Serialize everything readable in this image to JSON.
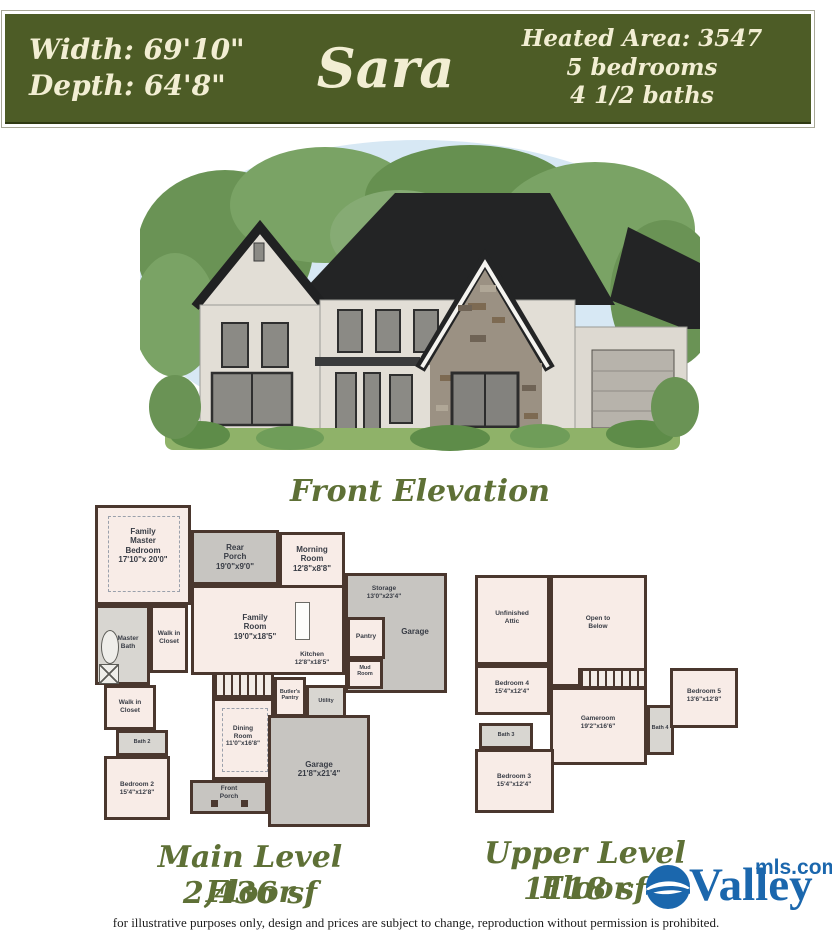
{
  "banner": {
    "width_label": "Width: 69'10\"",
    "depth_label": "Depth: 64'8\"",
    "plan_name": "Sara",
    "heated_area": "Heated Area: 3547",
    "bedrooms": "5 bedrooms",
    "baths": "4 1/2 baths"
  },
  "elevation": {
    "caption": "Front Elevation"
  },
  "main_level": {
    "caption": "Main Level Floor",
    "area": "2,436 sf",
    "rooms": {
      "family_master_bedroom": "Family\nMaster\nBedroom\n17'10\"x 20'0\"",
      "rear_porch": "Rear\nPorch\n19'0\"x9'0\"",
      "morning_room": "Morning\nRoom\n12'8\"x8'8\"",
      "family_room": "Family\nRoom\n19'0\"x18'5\"",
      "kitchen": "Kitchen\n12'8\"x18'5\"",
      "storage": "Storage\n13'0\"x23'4\"",
      "garage_side": "Garage",
      "pantry": "Pantry",
      "mud_room": "Mud\nRoom",
      "master_bath": "Master\nBath",
      "walk_in_closet_a": "Walk in\nCloset",
      "walk_in_closet_b": "Walk in\nCloset",
      "butlers_pantry": "Butler's\nPantry",
      "utility": "Utility",
      "dining_room": "Dining\nRoom\n11'0\"x16'8\"",
      "bath_2": "Bath 2",
      "bedroom_2": "Bedroom 2\n15'4\"x12'8\"",
      "front_porch": "Front\nPorch",
      "garage_main": "Garage\n21'8\"x21'4\""
    }
  },
  "upper_level": {
    "caption": "Upper Level Floor",
    "area": "1118 sf",
    "rooms": {
      "unfinished_attic": "Unfinished\nAttic",
      "open_to_below": "Open to\nBelow",
      "bedroom_4": "Bedroom 4\n15'4\"x12'4\"",
      "bedroom_5": "Bedroom 5\n13'6\"x12'8\"",
      "gameroom": "Gameroom\n19'2\"x16'6\"",
      "bath_3": "Bath 3",
      "bath_4": "Bath 4",
      "bedroom_3": "Bedroom 3\n15'4\"x12'4\""
    }
  },
  "footer": {
    "disclaimer": "for illustrative purposes only, design and prices are subject to change, reproduction without permission is prohibited.",
    "logo_valley": "Valley",
    "logo_mls": "mls.com"
  },
  "colors": {
    "banner_green": "#4d5c26",
    "banner_text_cream": "#f2eed3",
    "caption_olive": "#5e7036",
    "plan_wall_brown": "#4a372e",
    "room_fill_pink": "#f8ece7",
    "porch_garage_grey": "#c7c5c1",
    "logo_blue": "#1b67ad"
  }
}
